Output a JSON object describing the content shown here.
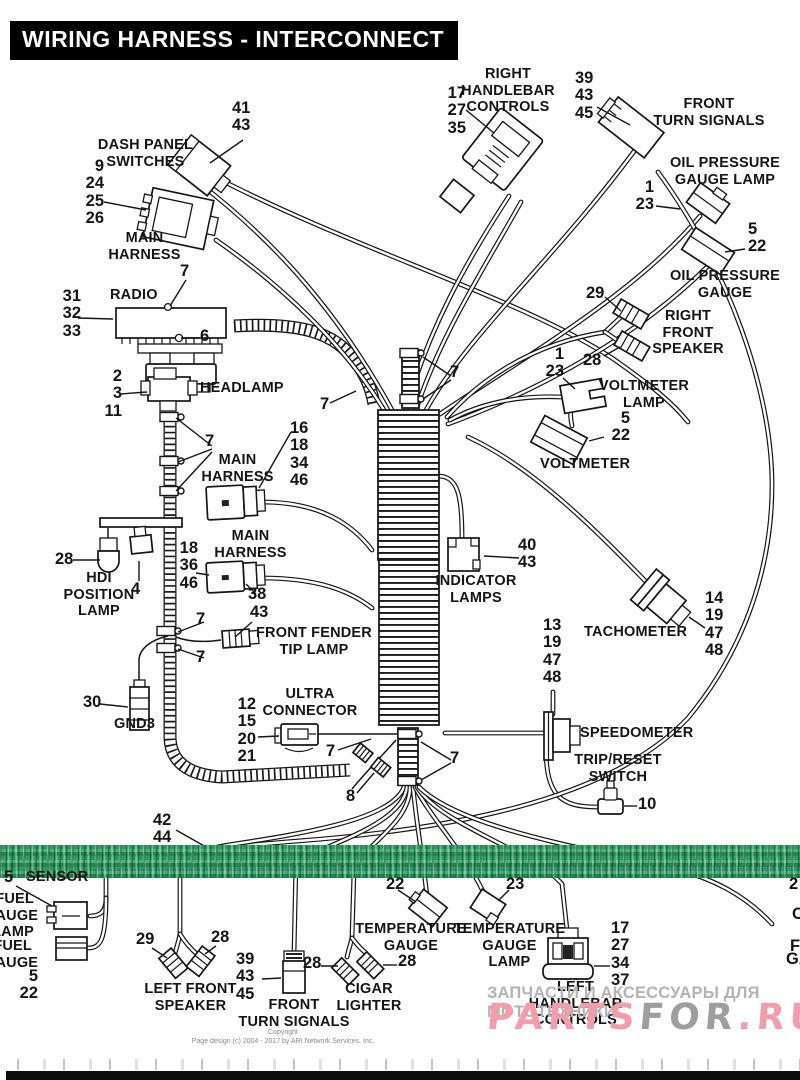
{
  "title": "WIRING HARNESS - INTERCONNECT",
  "labels": {
    "ref_41_43": "41\n43",
    "dash_panel_switches": "DASH PANEL\nSWITCHES",
    "ref_9_24_25_26": "9\n24\n25\n26",
    "main_harness_a": "MAIN\nHARNESS",
    "ref_31_32_33": "31\n32\n33",
    "radio": "RADIO",
    "ref_7_radio": "7",
    "ref_6": "6",
    "ref_2_3_11": "2\n3\n11",
    "headlamp": "HEADLAMP",
    "ref_7_headlamp": "7",
    "main_harness_b": "MAIN\nHARNESS",
    "ref_16_18_34_46": "16\n18\n34\n46",
    "main_harness_c": "MAIN\nHARNESS",
    "ref_18_36_46": "18\n36\n46",
    "ref_38": "38",
    "ref_43_fender": "43",
    "ref_28_hdi": "28",
    "hdi_position_lamp": "HDI\nPOSITION\nLAMP",
    "ref_4": "4",
    "ref_7_clamp_a": "7",
    "ref_7_clamp_b": "7",
    "ref_30": "30",
    "gnd3": "GND3",
    "front_fender_tip_lamp": "FRONT FENDER\nTIP LAMP",
    "ultra_connector": "ULTRA\nCONNECTOR",
    "ref_12_15_20_21": "12\n15\n20\n21",
    "ref_7_ultra": "7",
    "ref_8": "8",
    "ref_7_mid_left": "7",
    "ref_7_mid_right": "7",
    "ref_7_stub": "7",
    "indicator_lamps": "INDICATOR\nLAMPS",
    "ref_40_43": "40\n43",
    "ref_13_19_47_48": "13\n19\n47\n48",
    "tachometer": "TACHOMETER",
    "ref_14_19_47_48": "14\n19\n47\n48",
    "speedometer": "SPEEDOMETER",
    "trip_reset_switch": "TRIP/RESET\nSWITCH",
    "ref_10": "10",
    "ref_42_44": "42\n44",
    "sensor_ref": "5",
    "sensor": "SENSOR",
    "fuel_gauge_lamp": "FUEL\nGAUGE\nLAMP",
    "fuel_gauge": "FUEL\nGAUGE",
    "ref_5_22_fuel": "5\n22",
    "ref_29_lfs": "29",
    "ref_28_lfs": "28",
    "left_front_speaker": "LEFT FRONT\nSPEAKER",
    "ref_39_43_45_b": "39\n43\n45",
    "front_turn_signals_b": "FRONT\nTURN SIGNALS",
    "ref_28_cigar": "28",
    "cigar_lighter": "CIGAR\nLIGHTER",
    "temperature_gauge": "TEMPERATURE\nGAUGE",
    "ref_28_temp": "28",
    "ref_22_temp": "22",
    "temperature_gauge_lamp": "TEMPERATURE\nGAUGE\nLAMP",
    "ref_23_temp": "23",
    "ref_17_27_34_37": "17\n27\n34\n37",
    "left_handlebar_controls": "LEFT\nHANDLEBAR\nCONTROLS",
    "right_handlebar_controls": "RIGHT\nHANDLEBAR\nCONTROLS",
    "ref_17_27_35": "17\n27\n35",
    "ref_39_43_45_t": "39\n43\n45",
    "front_turn_signals_t": "FRONT\nTURN SIGNALS",
    "oil_pressure_gauge_lamp": "OIL PRESSURE\nGAUGE LAMP",
    "ref_1_23_opl": "1\n23",
    "ref_5_22_opg": "5\n22",
    "oil_pressure_gauge": "OIL PRESSURE\nGAUGE",
    "ref_29_rfs": "29",
    "ref_28_rfs": "28",
    "right_front_speaker": "RIGHT\nFRONT\nSPEAKER",
    "ref_1_23_vl": "1\n23",
    "voltmeter_lamp": "VOLTMETER\nLAMP",
    "ref_5_22_vm": "5\n22",
    "voltmeter": "VOLTMETER",
    "frag_right_1": "2",
    "frag_right_2": "C",
    "frag_right_3": "F",
    "frag_right_4": "GA"
  },
  "watermark": {
    "tagline": "ЗАПЧАСТИ И АКСЕССУАРЫ ДЛЯ МОТОТЕХНИКИ",
    "logo_left": "PARTS",
    "logo_mid": "FOR",
    "logo_right": ".RU"
  },
  "footer": {
    "line1": "Copyright",
    "line2": "Page design (c) 2004 - 2017 by ARI Network Services, Inc."
  },
  "colors": {
    "band_green": "#2d9a63",
    "watermark_pink": "#f19dab",
    "watermark_gray": "#9e9e9e",
    "banner_bg": "#000000"
  }
}
